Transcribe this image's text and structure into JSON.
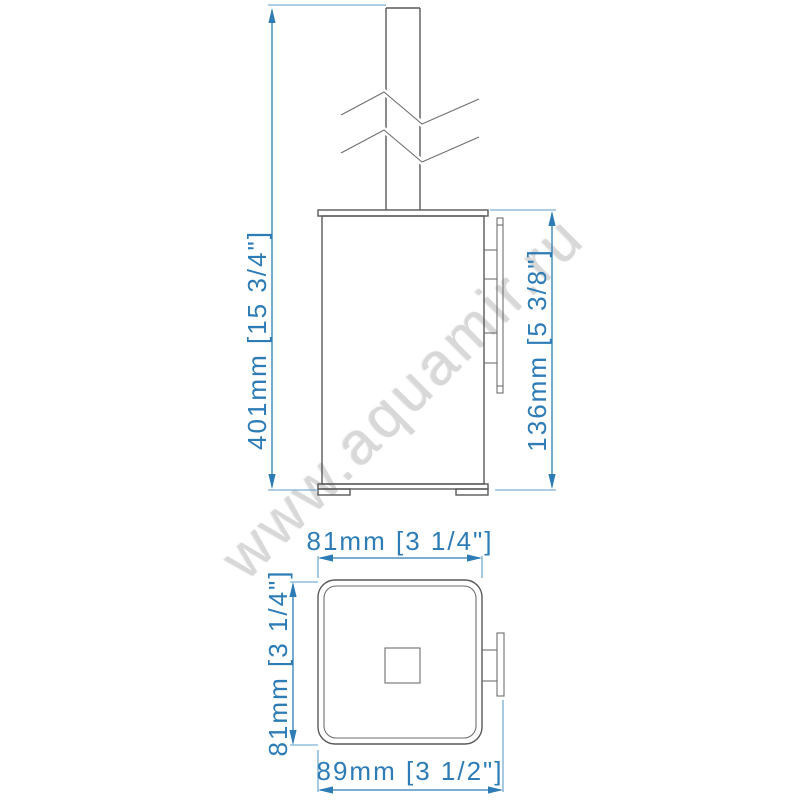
{
  "watermark": {
    "text": "www.aquamir.ru"
  },
  "colors": {
    "dimension_blue": "#2d7cb5",
    "drawing_gray": "#585858",
    "watermark_gray": "#d8d8d8",
    "background": "#ffffff"
  },
  "front_view": {
    "dim_total_height": "401mm [15 3/4\"]",
    "dim_holder_height": "136mm [5 3/8\"]"
  },
  "top_view": {
    "dim_width": "81mm [3 1/4\"]",
    "dim_depth": "81mm [3 1/4\"]",
    "dim_total_depth": "89mm [3 1/2\"]"
  }
}
